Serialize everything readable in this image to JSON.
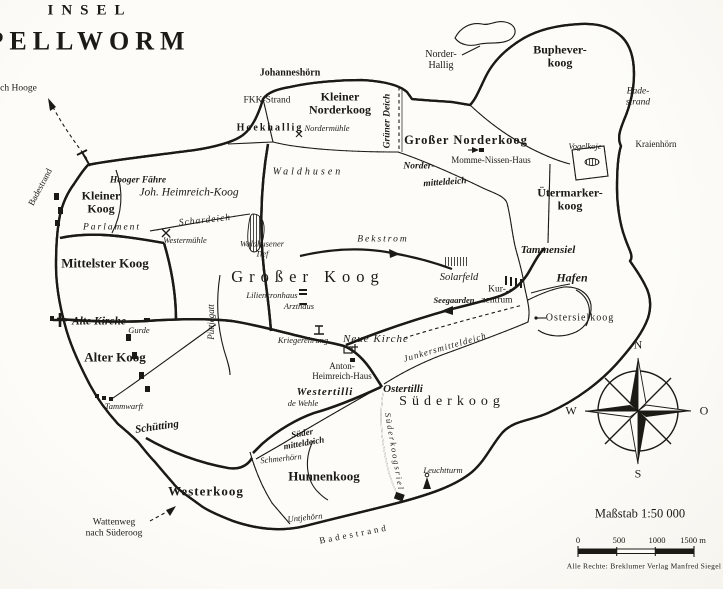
{
  "title": {
    "line1": "INSEL",
    "line2": "PELLWORM"
  },
  "compass": {
    "north": "N",
    "east": "O",
    "south": "S",
    "west": "W"
  },
  "scale": {
    "caption": "Maßstab 1:50 000",
    "ticks": [
      "0",
      "500",
      "1000",
      "1500 m"
    ]
  },
  "credit": "Alle Rechte: Breklumer Verlag Manfred Siegel",
  "colors": {
    "ink": "#1c1a15",
    "paper": "#fdfcf9"
  },
  "map": {
    "labels": [
      {
        "id": "title-insel",
        "t": "INSEL",
        "x": 90,
        "y": 11,
        "fs": 15,
        "ls": 8,
        "b": 1
      },
      {
        "id": "title-pellworm",
        "t": "PELLWORM",
        "x": 89,
        "y": 41,
        "fs": 26,
        "ls": 6,
        "b": 1
      },
      {
        "id": "nach-hooge",
        "t": "nach Hooge",
        "x": 14,
        "y": 89,
        "fs": 9.5
      },
      {
        "id": "johanneshoern",
        "t": "Johanneshörn",
        "x": 290,
        "y": 73,
        "fs": 10,
        "b": 1
      },
      {
        "id": "fkk-strand",
        "t": "FKK-Strand",
        "x": 267,
        "y": 101,
        "fs": 9.5
      },
      {
        "id": "hoekhallig",
        "t": "Hoekhallig",
        "x": 270,
        "y": 128,
        "fs": 10,
        "b": 1,
        "ls": 2
      },
      {
        "id": "kleiner-norderkoog",
        "t": "Kleiner\nNorderkoog",
        "x": 340,
        "y": 104,
        "fs": 12,
        "b": 1
      },
      {
        "id": "nordermuehle",
        "t": "Nordermühle",
        "x": 327,
        "y": 129,
        "fs": 8.5,
        "it": 1
      },
      {
        "id": "gruener-deich",
        "t": "Grüner Deich",
        "x": 388,
        "y": 121,
        "fs": 9.5,
        "b": 1,
        "it": 1,
        "rot": -90
      },
      {
        "id": "norder-hallig",
        "t": "Norder-\nHallig",
        "x": 441,
        "y": 60,
        "fs": 10
      },
      {
        "id": "grosser-norderkoog",
        "t": "Großer Norderkoog",
        "x": 466,
        "y": 140,
        "fs": 12.5,
        "b": 1,
        "ls": 1
      },
      {
        "id": "momme-nissen-haus",
        "t": "Momme-Nissen-Haus",
        "x": 491,
        "y": 160,
        "fs": 9
      },
      {
        "id": "norder-mitteldeich-1",
        "t": "Norder-",
        "x": 419,
        "y": 167,
        "fs": 9.5,
        "b": 1,
        "it": 1
      },
      {
        "id": "norder-mitteldeich-2",
        "t": "mitteldeich",
        "x": 445,
        "y": 183,
        "fs": 9.5,
        "b": 1,
        "it": 1,
        "rot": -4
      },
      {
        "id": "buphever-koog",
        "t": "Buphever-\nkoog",
        "x": 560,
        "y": 57,
        "fs": 12,
        "b": 1
      },
      {
        "id": "bade-strand",
        "t": "Bade-\nstrand",
        "x": 638,
        "y": 97,
        "fs": 9.5,
        "it": 1
      },
      {
        "id": "kraienhoern",
        "t": "Kraienhörn",
        "x": 656,
        "y": 144,
        "fs": 9
      },
      {
        "id": "vogelkoje",
        "t": "Vogelkoje",
        "x": 585,
        "y": 147,
        "fs": 8.5,
        "it": 1
      },
      {
        "id": "uetermarker-koog",
        "t": "Ütermarker-\nkoog",
        "x": 570,
        "y": 200,
        "fs": 12,
        "b": 1
      },
      {
        "id": "badestrand-west",
        "t": "Badestrand",
        "x": 40,
        "y": 187,
        "fs": 9,
        "rot": -62
      },
      {
        "id": "hooger-faehre",
        "t": "Hooger Fähre",
        "x": 138,
        "y": 181,
        "fs": 9.5,
        "it": 1,
        "b": 1
      },
      {
        "id": "joh-heimreich-koog",
        "t": "Joh. Heimreich-Koog",
        "x": 189,
        "y": 193,
        "fs": 11.5,
        "it": 1
      },
      {
        "id": "kleiner-koog",
        "t": "Kleiner\nKoog",
        "x": 101,
        "y": 203,
        "fs": 12,
        "b": 1
      },
      {
        "id": "parlament",
        "t": "Parlament",
        "x": 112,
        "y": 228,
        "fs": 9.5,
        "it": 1,
        "ls": 2
      },
      {
        "id": "schardeich",
        "t": "Schardeich",
        "x": 205,
        "y": 221,
        "fs": 9.5,
        "it": 1,
        "ls": 1,
        "rot": -6
      },
      {
        "id": "westermuehle",
        "t": "Westermühle",
        "x": 185,
        "y": 241,
        "fs": 8.5,
        "it": 1
      },
      {
        "id": "mittelster-koog",
        "t": "Mittelster Koog",
        "x": 105,
        "y": 264,
        "fs": 13,
        "b": 1
      },
      {
        "id": "waldhusen",
        "t": "Waldhusen",
        "x": 308,
        "y": 172,
        "fs": 10,
        "it": 1,
        "ls": 3
      },
      {
        "id": "waldhusener-tief",
        "t": "Waldhusener\nTief",
        "x": 262,
        "y": 249,
        "fs": 8.5,
        "it": 1
      },
      {
        "id": "bekstrom",
        "t": "Bekstrom",
        "x": 383,
        "y": 240,
        "fs": 9.5,
        "it": 1,
        "ls": 2
      },
      {
        "id": "grosser-koog",
        "t": "Großer Koog",
        "x": 308,
        "y": 277,
        "fs": 16.5,
        "ls": 6
      },
      {
        "id": "liliencronhaus",
        "t": "Liliencronhaus",
        "x": 272,
        "y": 296,
        "fs": 8.5,
        "it": 1
      },
      {
        "id": "arzthaus",
        "t": "Arzthaus",
        "x": 299,
        "y": 307,
        "fs": 8.5,
        "it": 1
      },
      {
        "id": "puettjegatt",
        "t": "Püttjegatt",
        "x": 211,
        "y": 322,
        "fs": 9,
        "it": 1,
        "rot": -90
      },
      {
        "id": "kriegerehrung",
        "t": "Kriegerehrung",
        "x": 303,
        "y": 341,
        "fs": 8.5,
        "it": 1
      },
      {
        "id": "neue-kirche",
        "t": "Neue Kirche",
        "x": 376,
        "y": 339,
        "fs": 11,
        "it": 1,
        "ls": 1
      },
      {
        "id": "anton-heimreich-haus",
        "t": "Anton-\nHeimreich-Haus",
        "x": 342,
        "y": 371,
        "fs": 9
      },
      {
        "id": "westertilli",
        "t": "Westertilli",
        "x": 325,
        "y": 392,
        "fs": 11,
        "it": 1,
        "b": 1,
        "ls": 1
      },
      {
        "id": "ostertilli",
        "t": "Ostertilli",
        "x": 403,
        "y": 389,
        "fs": 11,
        "it": 1,
        "b": 1
      },
      {
        "id": "de-wehle",
        "t": "de Wehle",
        "x": 303,
        "y": 404,
        "fs": 8.5,
        "it": 1
      },
      {
        "id": "junkersmitteldeich",
        "t": "Junkersmitteldeich",
        "x": 445,
        "y": 347,
        "fs": 9,
        "it": 1,
        "rot": -16,
        "ls": 1
      },
      {
        "id": "suederkoog",
        "t": "Süderkoog",
        "x": 452,
        "y": 402,
        "fs": 14,
        "ls": 5
      },
      {
        "id": "alte-kirche",
        "t": "Alte Kirche",
        "x": 99,
        "y": 322,
        "fs": 11.5,
        "it": 1,
        "b": 1
      },
      {
        "id": "gurde",
        "t": "Gurde",
        "x": 139,
        "y": 331,
        "fs": 8.5,
        "it": 1
      },
      {
        "id": "alter-koog",
        "t": "Alter Koog",
        "x": 115,
        "y": 358,
        "fs": 13,
        "b": 1
      },
      {
        "id": "tammwarft",
        "t": "Tammwarft",
        "x": 124,
        "y": 407,
        "fs": 8.5,
        "it": 1
      },
      {
        "id": "schuetting",
        "t": "Schütting",
        "x": 157,
        "y": 427,
        "fs": 11,
        "it": 1,
        "b": 1,
        "rot": -8
      },
      {
        "id": "sueder-mitteldeich",
        "t": "Süder\nmitteldeich",
        "x": 303,
        "y": 438,
        "fs": 9,
        "it": 1,
        "b": 1,
        "rot": -10
      },
      {
        "id": "schmerhoern",
        "t": "Schmerhörn",
        "x": 281,
        "y": 459,
        "fs": 8.5,
        "it": 1,
        "rot": -6
      },
      {
        "id": "hunnenkoog",
        "t": "Hunnenkoog",
        "x": 324,
        "y": 477,
        "fs": 13,
        "b": 1
      },
      {
        "id": "westerkoog",
        "t": "Westerkoog",
        "x": 206,
        "y": 492,
        "fs": 13,
        "b": 1,
        "ls": 1
      },
      {
        "id": "wattenweg-nach-suederoog",
        "t": "Wattenweg\nnach Süderoog",
        "x": 114,
        "y": 528,
        "fs": 9.5
      },
      {
        "id": "untjehoern",
        "t": "Untjehörn",
        "x": 305,
        "y": 518,
        "fs": 8.5,
        "it": 1,
        "rot": -6
      },
      {
        "id": "badestrand-sued",
        "t": "Badestrand",
        "x": 354,
        "y": 534,
        "fs": 9,
        "rot": -11,
        "ls": 3
      },
      {
        "id": "suederkoogsriel",
        "t": "Süderkoogsriel",
        "x": 394,
        "y": 452,
        "fs": 8.5,
        "it": 1,
        "rot": 80,
        "ls": 2
      },
      {
        "id": "leuchtturm",
        "t": "Leuchtturm",
        "x": 443,
        "y": 471,
        "fs": 8.5,
        "it": 1
      },
      {
        "id": "tammensiel",
        "t": "Tammensiel",
        "x": 548,
        "y": 250,
        "fs": 11,
        "it": 1,
        "b": 1
      },
      {
        "id": "hafen",
        "t": "Hafen",
        "x": 572,
        "y": 278,
        "fs": 12,
        "it": 1,
        "b": 1
      },
      {
        "id": "solarfeld",
        "t": "Solarfeld",
        "x": 459,
        "y": 278,
        "fs": 10.5,
        "it": 1
      },
      {
        "id": "kur-zentrum",
        "t": "Kur-\nzentrum",
        "x": 497,
        "y": 295,
        "fs": 9.5
      },
      {
        "id": "seegaarden",
        "t": "Seegaarden",
        "x": 454,
        "y": 301,
        "fs": 8.5,
        "it": 1,
        "b": 1
      },
      {
        "id": "ostersielkoog",
        "t": "Ostersielkoog",
        "x": 580,
        "y": 318,
        "fs": 10,
        "ls": 1
      }
    ]
  }
}
